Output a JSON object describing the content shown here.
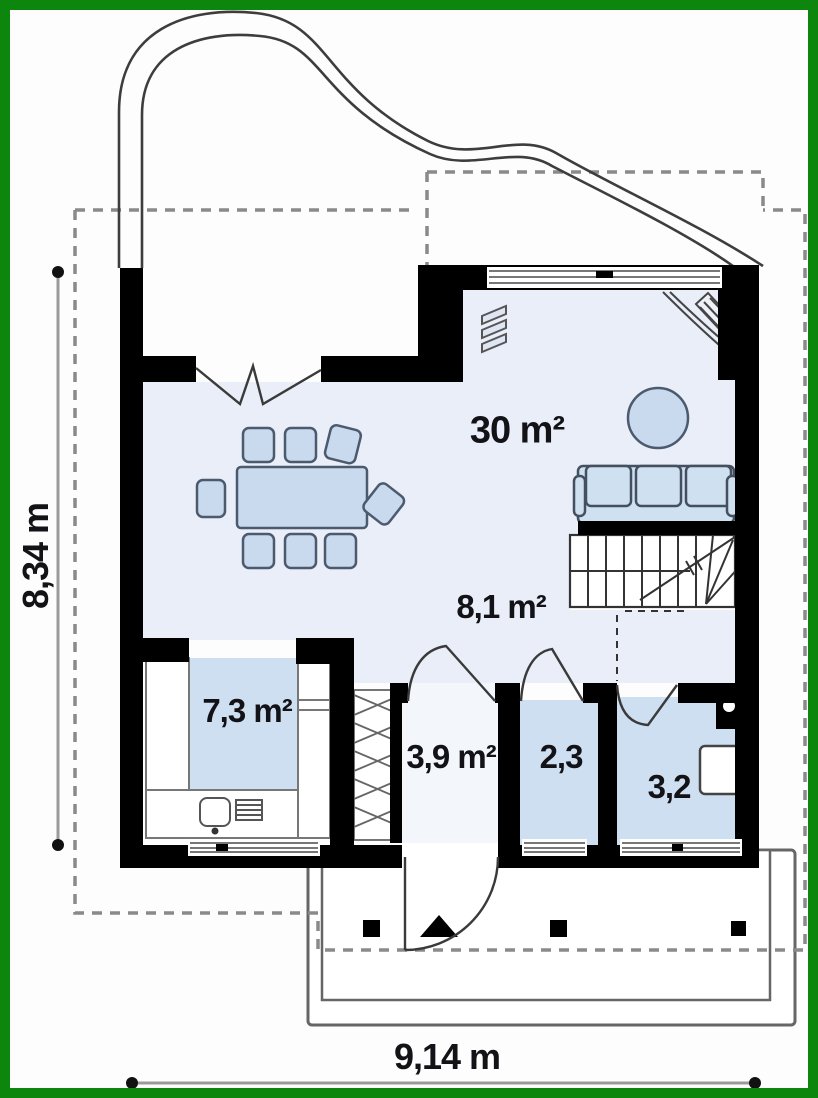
{
  "plan": {
    "type": "house ground floor plan",
    "floor_note": "ground floor with living-dining room, kitchen, hall, vestibule, wc, bathroom, stairs and entrance porch"
  },
  "rooms": {
    "living": {
      "label": "30 m²"
    },
    "hall": {
      "label": "8,1 m²"
    },
    "kitchen": {
      "label": "7,3 m²"
    },
    "vestibule": {
      "label": "3,9 m²"
    },
    "wc": {
      "label": "2,3"
    },
    "bath": {
      "label": "3,2"
    }
  },
  "dimensions": {
    "depth": {
      "label": "8,34 m"
    },
    "width": {
      "label": "9,14 m"
    }
  },
  "colors": {
    "frame_green": "#0c860c",
    "wall_black": "#000000",
    "floor_light": "#e9eef8",
    "floor_medium": "#cfdff2",
    "floor_vestibule": "#f3f6fb",
    "furniture_fill": "#c9daef",
    "dash_gray": "#8a8a8a",
    "dim_gray": "#9a9a9a",
    "line_dark": "#3d3d3d"
  }
}
